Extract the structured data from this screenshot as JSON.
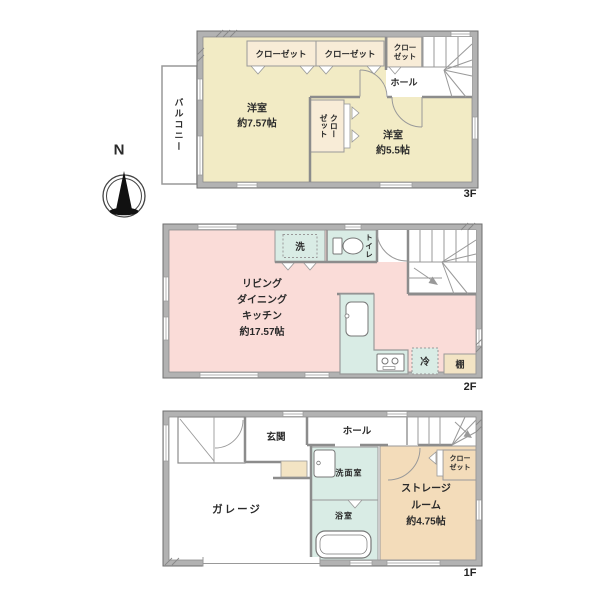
{
  "compass": {
    "north": "N"
  },
  "floor3": {
    "tag": "3F",
    "balcony": "バルコニー",
    "closet_top_1": "クローゼット",
    "closet_top_2": "クローゼット",
    "closet_top_3_line1": "クロー",
    "closet_top_3_line2": "ゼット",
    "hall": "ホール",
    "closet_mid_col1": "クロー",
    "closet_mid_col2": "ゼット",
    "room_a_name": "洋室",
    "room_a_area": "約7.57帖",
    "room_b_name": "洋室",
    "room_b_area": "約5.5帖"
  },
  "floor2": {
    "tag": "2F",
    "ldk_line1": "リビング",
    "ldk_line2": "ダイニング",
    "ldk_line3": "キッチン",
    "ldk_area": "約17.57帖",
    "laundry": "洗",
    "toilet": "トイレ",
    "refrigerator": "冷",
    "shelf": "棚"
  },
  "floor1": {
    "tag": "1F",
    "entrance": "玄関",
    "hall": "ホール",
    "garage": "ガレージ",
    "washroom": "洗面室",
    "bathroom": "浴室",
    "storage_line1": "ストレージ",
    "storage_line2": "ルーム",
    "storage_area": "約4.75帖",
    "closet_line1": "クロー",
    "closet_line2": "ゼット"
  },
  "colors": {
    "wall": "#b2b2b2",
    "room_yellow": "#f2ebc5",
    "closet_peach": "#f8ecd7",
    "ldk_pink": "#fadcd8",
    "wet_mint": "#d9ece5",
    "storage_tan": "#f3dcba",
    "step_beige": "#f3e4c4"
  }
}
